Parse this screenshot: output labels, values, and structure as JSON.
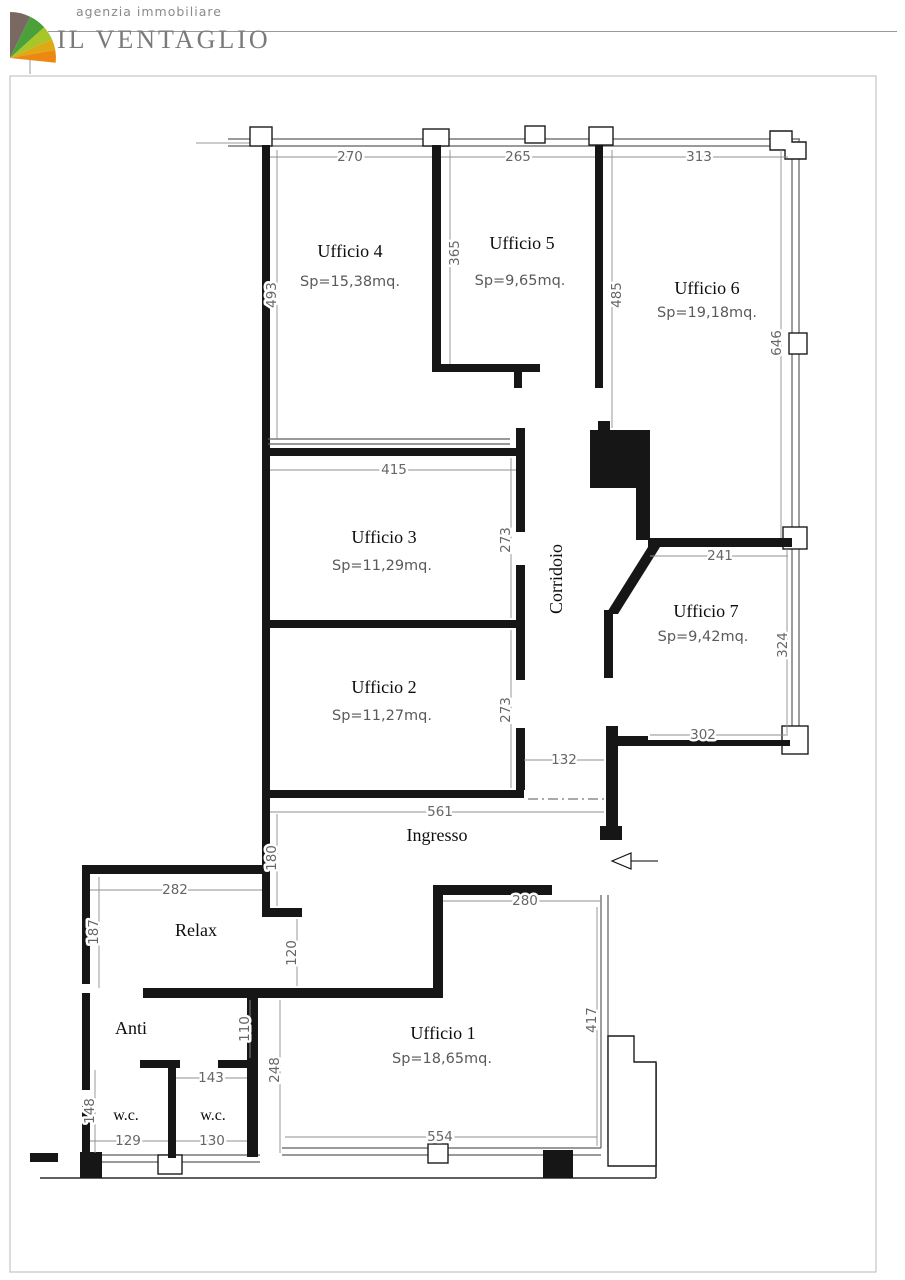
{
  "header": {
    "tagline": "agenzia immobiliare",
    "brand": "IL VENTAGLIO",
    "logo_colors": {
      "wedge1": "#7a6963",
      "wedge2": "#4aa13a",
      "wedge3": "#a8c62a",
      "wedge4": "#dfa815",
      "wedge5": "#ec8812"
    }
  },
  "plan": {
    "rooms": [
      {
        "name": "Ufficio 4",
        "area": "Sp=15,38mq."
      },
      {
        "name": "Ufficio 5",
        "area": "Sp=9,65mq."
      },
      {
        "name": "Ufficio 6",
        "area": "Sp=19,18mq."
      },
      {
        "name": "Ufficio 3",
        "area": "Sp=11,29mq."
      },
      {
        "name": "Ufficio 2",
        "area": "Sp=11,27mq."
      },
      {
        "name": "Ufficio 7",
        "area": "Sp=9,42mq."
      },
      {
        "name": "Ufficio 1",
        "area": "Sp=18,65mq."
      },
      {
        "name": "Corridoio"
      },
      {
        "name": "Ingresso"
      },
      {
        "name": "Relax"
      },
      {
        "name": "Anti"
      },
      {
        "name": "w.c."
      },
      {
        "name": "w.c."
      }
    ],
    "dims": {
      "u4_w": "270",
      "u5_w": "265",
      "u6_w": "313",
      "u4_h": "493",
      "u45_h": "365",
      "u5_h": "485",
      "u6_h": "646",
      "u3_w": "415",
      "u3_h": "273",
      "u2_h": "273",
      "u7_w": "241",
      "u7_h": "324",
      "u7_b": "302",
      "niche": "132",
      "ingresso_w": "561",
      "ingresso_h": "180",
      "relax_w": "282",
      "relax_h": "187",
      "relax_anti": "120",
      "anti_h": "110",
      "wc_h": "148",
      "wc1_w": "129",
      "wc2_w": "130",
      "wc_top": "143",
      "anti_e": "248",
      "u1_top": "280",
      "u1_h": "417",
      "u1_w": "554"
    }
  }
}
